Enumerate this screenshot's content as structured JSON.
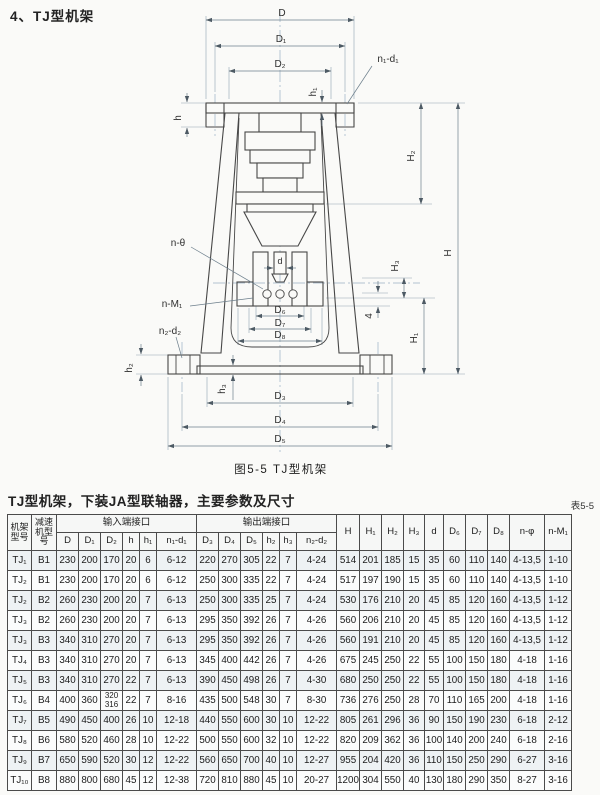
{
  "page": {
    "title": "4、TJ型机架",
    "figure_caption": "图5-5 TJ型机架",
    "table_title": "TJ型机架，下装JA型联轴器，主要参数及尺寸",
    "table_tag": "表5-5"
  },
  "diagram": {
    "description": "TJ型机架剖面尺寸图",
    "labels": {
      "D": "D",
      "D1": "D₁",
      "D2": "D₂",
      "n1d1": "n₁-d₁",
      "h": "h",
      "h1": "h₁",
      "H2": "H₂",
      "H": "H",
      "ntheta": "n-θ",
      "d": "d",
      "H3": "H₃",
      "nM1": "n-M₁",
      "four": "4",
      "D6": "D₆",
      "D7": "D₇",
      "D8": "D₈",
      "H1": "H₁",
      "n2d2": "n₂-d₂",
      "h2": "h₂",
      "h3": "h₃",
      "D3": "D₃",
      "D4": "D₄",
      "D5": "D₅"
    }
  },
  "table": {
    "header": {
      "col_frame": "机架\n型号",
      "col_reducer": "减速\n机型\n号",
      "group_input": "输入端接口",
      "group_output": "输出端接口",
      "input_cols": [
        "D",
        "D₁",
        "D₂",
        "h",
        "h₁",
        "n₁-d₁"
      ],
      "output_cols": [
        "D₃",
        "D₄",
        "D₅",
        "h₂",
        "h₃",
        "n₂-d₂"
      ],
      "tail_cols": [
        "H",
        "H₁",
        "H₂",
        "H₃",
        "d",
        "D₆",
        "D₇",
        "D₈",
        "n-φ",
        "n-M₁"
      ]
    },
    "rows": [
      [
        "TJ₁",
        "B1",
        "230",
        "200",
        "170",
        "20",
        "6",
        "6-12",
        "220",
        "270",
        "305",
        "22",
        "7",
        "4-24",
        "514",
        "201",
        "185",
        "15",
        "35",
        "60",
        "110",
        "140",
        "4-13,5",
        "1-10"
      ],
      [
        "TJ₂",
        "B1",
        "230",
        "200",
        "170",
        "20",
        "6",
        "6-12",
        "250",
        "300",
        "335",
        "22",
        "7",
        "4-24",
        "517",
        "197",
        "190",
        "15",
        "35",
        "60",
        "110",
        "140",
        "4-13,5",
        "1-10"
      ],
      [
        "TJ₂",
        "B2",
        "260",
        "230",
        "200",
        "20",
        "7",
        "6-13",
        "250",
        "300",
        "335",
        "25",
        "7",
        "4-24",
        "530",
        "176",
        "210",
        "20",
        "45",
        "85",
        "120",
        "160",
        "4-13,5",
        "1-12"
      ],
      [
        "TJ₃",
        "B2",
        "260",
        "230",
        "200",
        "20",
        "7",
        "6-13",
        "295",
        "350",
        "392",
        "26",
        "7",
        "4-26",
        "560",
        "206",
        "210",
        "20",
        "45",
        "85",
        "120",
        "160",
        "4-13,5",
        "1-12"
      ],
      [
        "TJ₃",
        "B3",
        "340",
        "310",
        "270",
        "20",
        "7",
        "6-13",
        "295",
        "350",
        "392",
        "26",
        "7",
        "4-26",
        "560",
        "191",
        "210",
        "20",
        "45",
        "85",
        "120",
        "160",
        "4-13,5",
        "1-12"
      ],
      [
        "TJ₄",
        "B3",
        "340",
        "310",
        "270",
        "20",
        "7",
        "6-13",
        "345",
        "400",
        "442",
        "26",
        "7",
        "4-26",
        "675",
        "245",
        "250",
        "22",
        "55",
        "100",
        "150",
        "180",
        "4-18",
        "1-16"
      ],
      [
        "TJ₅",
        "B3",
        "340",
        "310",
        "270",
        "22",
        "7",
        "6-13",
        "390",
        "450",
        "498",
        "26",
        "7",
        "4-30",
        "680",
        "250",
        "250",
        "22",
        "55",
        "100",
        "150",
        "180",
        "4-18",
        "1-16"
      ],
      [
        "TJ₆",
        "B4",
        "400",
        "360",
        "320\n316",
        "22",
        "7",
        "8-16",
        "435",
        "500",
        "548",
        "30",
        "7",
        "8-30",
        "736",
        "276",
        "250",
        "28",
        "70",
        "110",
        "165",
        "200",
        "4-18",
        "1-16"
      ],
      [
        "TJ₇",
        "B5",
        "490",
        "450",
        "400",
        "26",
        "10",
        "12-18",
        "440",
        "550",
        "600",
        "30",
        "10",
        "12-22",
        "805",
        "261",
        "296",
        "36",
        "90",
        "150",
        "190",
        "230",
        "6-18",
        "2-12"
      ],
      [
        "TJ₈",
        "B6",
        "580",
        "520",
        "460",
        "28",
        "10",
        "12-22",
        "500",
        "550",
        "600",
        "32",
        "10",
        "12-22",
        "820",
        "209",
        "362",
        "36",
        "100",
        "140",
        "200",
        "240",
        "6-18",
        "2-16"
      ],
      [
        "TJ₉",
        "B7",
        "650",
        "590",
        "520",
        "30",
        "12",
        "12-22",
        "560",
        "650",
        "700",
        "40",
        "10",
        "12-27",
        "955",
        "204",
        "420",
        "36",
        "110",
        "150",
        "250",
        "290",
        "6-27",
        "3-16"
      ],
      [
        "TJ₁₀",
        "B8",
        "880",
        "800",
        "680",
        "45",
        "12",
        "12-38",
        "720",
        "810",
        "880",
        "45",
        "10",
        "20-27",
        "1200",
        "304",
        "550",
        "40",
        "130",
        "180",
        "290",
        "350",
        "8-27",
        "3-16"
      ]
    ]
  }
}
